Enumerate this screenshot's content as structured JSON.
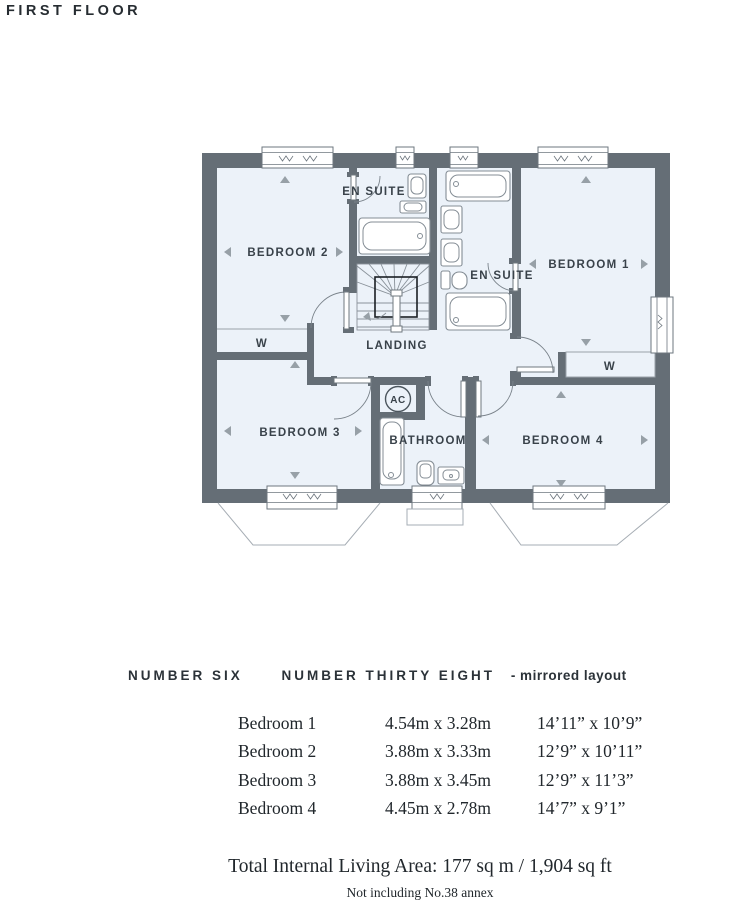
{
  "page_title": "FIRST FLOOR",
  "plan": {
    "labels": {
      "bedroom1": "BEDROOM 1",
      "bedroom2": "BEDROOM 2",
      "bedroom3": "BEDROOM 3",
      "bedroom4": "BEDROOM 4",
      "ensuite1": "EN SUITE",
      "ensuite2": "EN SUITE",
      "bathroom": "BATHROOM",
      "landing": "LANDING",
      "wardrobe1": "W",
      "wardrobe2": "W",
      "airing_cupboard": "AC"
    },
    "colors": {
      "wall": "#656e76",
      "room_fill": "#ecf2f9",
      "fixture_line": "#848d95",
      "label_text": "#39424a"
    }
  },
  "footer": {
    "heading": {
      "plot_left": "NUMBER SIX",
      "plot_right": "NUMBER THIRTY EIGHT",
      "suffix": "- mirrored layout"
    },
    "dimensions_table": {
      "rows": [
        {
          "room": "Bedroom 1",
          "metric": "4.54m x 3.28m",
          "imperial": "14’11” x 10’9”"
        },
        {
          "room": "Bedroom 2",
          "metric": "3.88m x 3.33m",
          "imperial": "12’9” x 10’11”"
        },
        {
          "room": "Bedroom 3",
          "metric": "3.88m x 3.45m",
          "imperial": "12’9” x 11’3”"
        },
        {
          "room": "Bedroom 4",
          "metric": "4.45m x 2.78m",
          "imperial": "14’7” x 9’1”"
        }
      ]
    },
    "total_area": "Total Internal Living Area: 177 sq m / 1,904 sq ft",
    "note": "Not including No.38 annex"
  }
}
